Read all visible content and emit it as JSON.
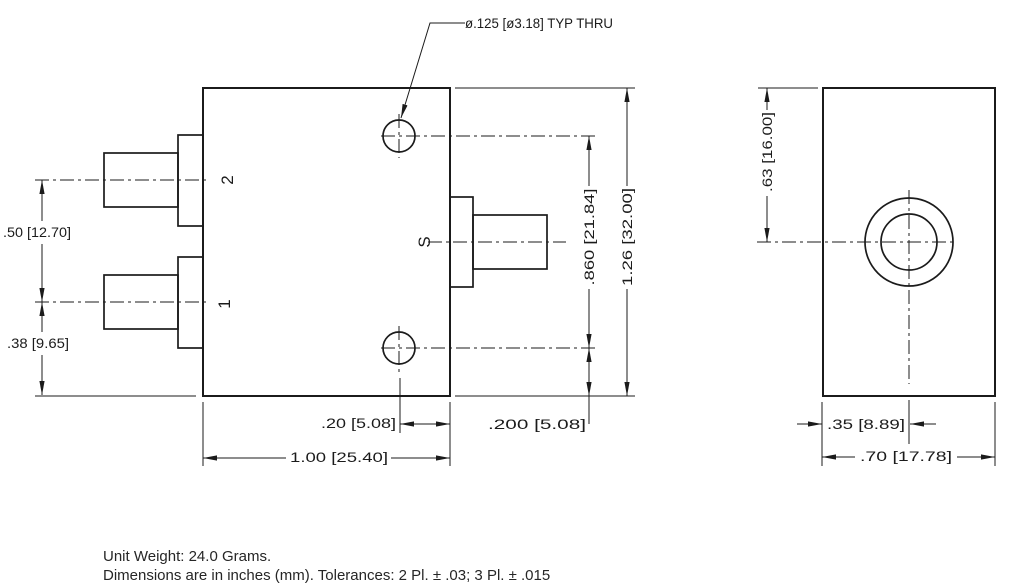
{
  "colors": {
    "line": "#1b1b1b",
    "background": "#ffffff"
  },
  "callout": {
    "hole_note": "ø.125 [ø3.18] TYP THRU"
  },
  "front_view": {
    "port_labels": {
      "port2": "2",
      "port1": "1",
      "sum_port": "S"
    },
    "dimensions": {
      "port_spacing": ".50 [12.70]",
      "port1_to_bottom_edge": ".38 [9.65]",
      "hole_to_right_edge": ".20 [5.08]",
      "body_width": "1.00 [25.40]",
      "hole_spacing": ".860 [21.84]",
      "body_height": "1.26 [32.00]",
      "hole_to_bottom_edge": ".200 [5.08]"
    }
  },
  "side_view": {
    "dimensions": {
      "top_to_connector_center": ".63 [16.00]",
      "edge_to_connector_center": ".35 [8.89]",
      "body_depth": ".70 [17.78]"
    }
  },
  "notes": {
    "line1": "Unit Weight: 24.0 Grams.",
    "line2": "Dimensions are in inches (mm). Tolerances: 2 Pl. ± .03; 3 Pl. ± .015"
  }
}
